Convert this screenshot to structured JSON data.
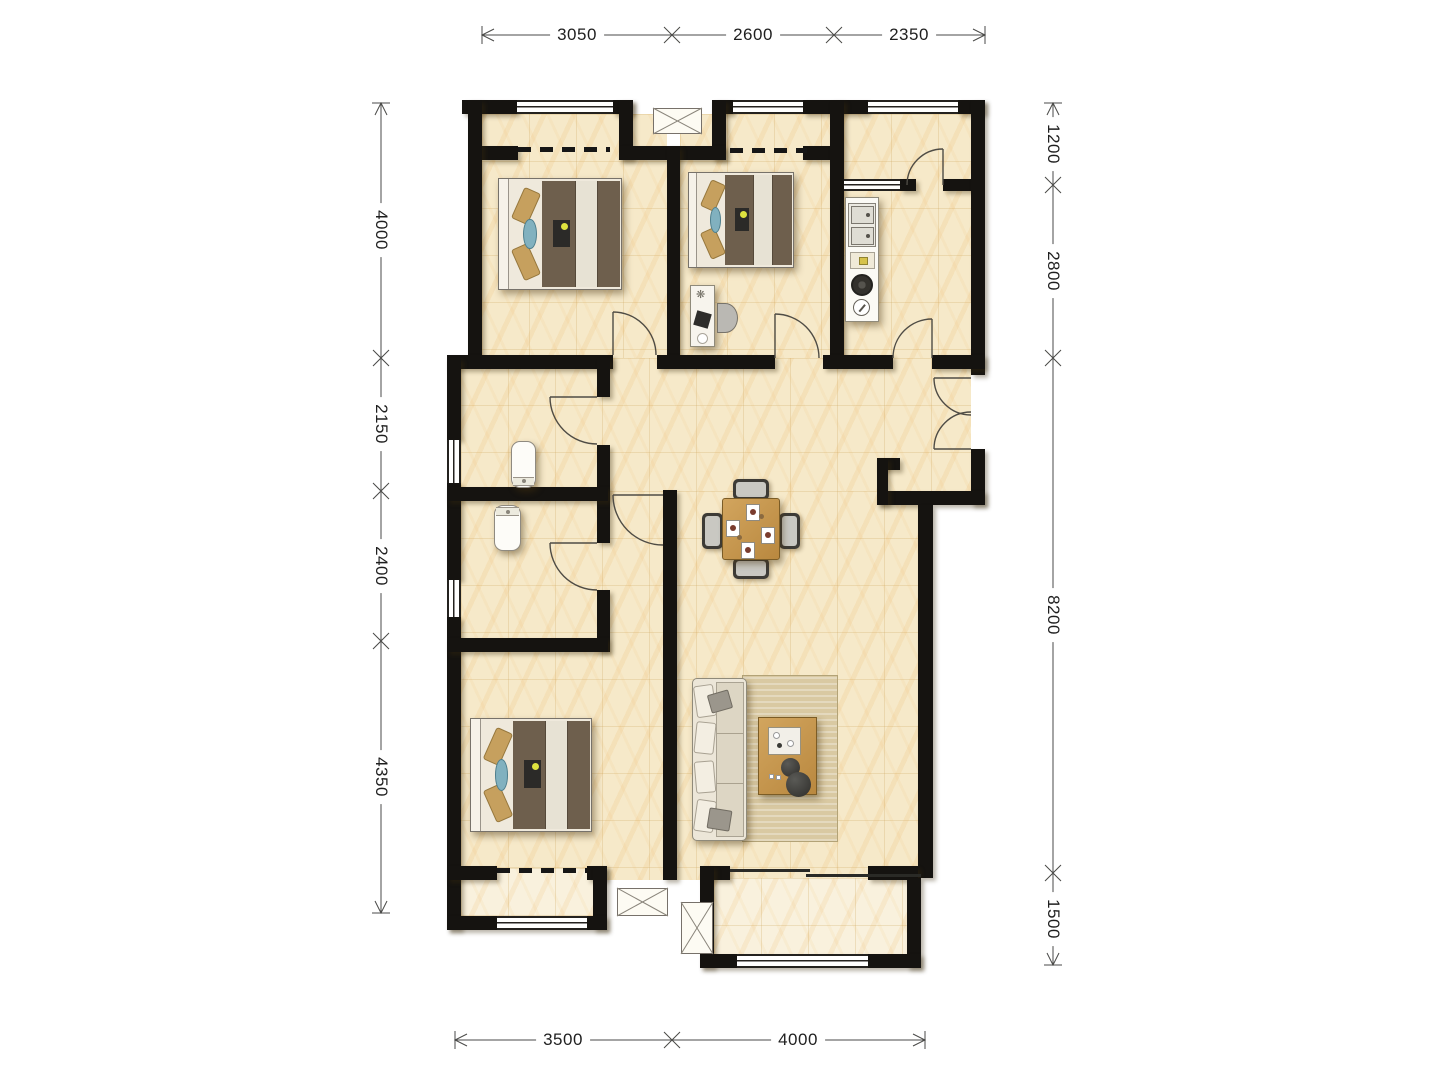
{
  "page": {
    "type": "architectural-floor-plan",
    "background": "#ffffff"
  },
  "dimensions": {
    "top": [
      "3050",
      "2600",
      "2350"
    ],
    "left": [
      "4000",
      "2150",
      "2400",
      "4350"
    ],
    "right": [
      "1200",
      "2800",
      "8200",
      "1500"
    ],
    "bottom": [
      "3500",
      "4000"
    ]
  },
  "colors": {
    "wall": "#151310",
    "floor": "#f6e9c9",
    "balcony_floor": "#f9f1dd",
    "wood": "#c79b55",
    "blanket": "#6e5f4d",
    "pillow": "#c6a05e",
    "accent_blue": "#81b1bf",
    "rug": "#d9c9a2",
    "dim_line": "#4a4a48",
    "dim_text": "#1f1f1f"
  },
  "icons": {
    "desk_plant": "❋"
  }
}
